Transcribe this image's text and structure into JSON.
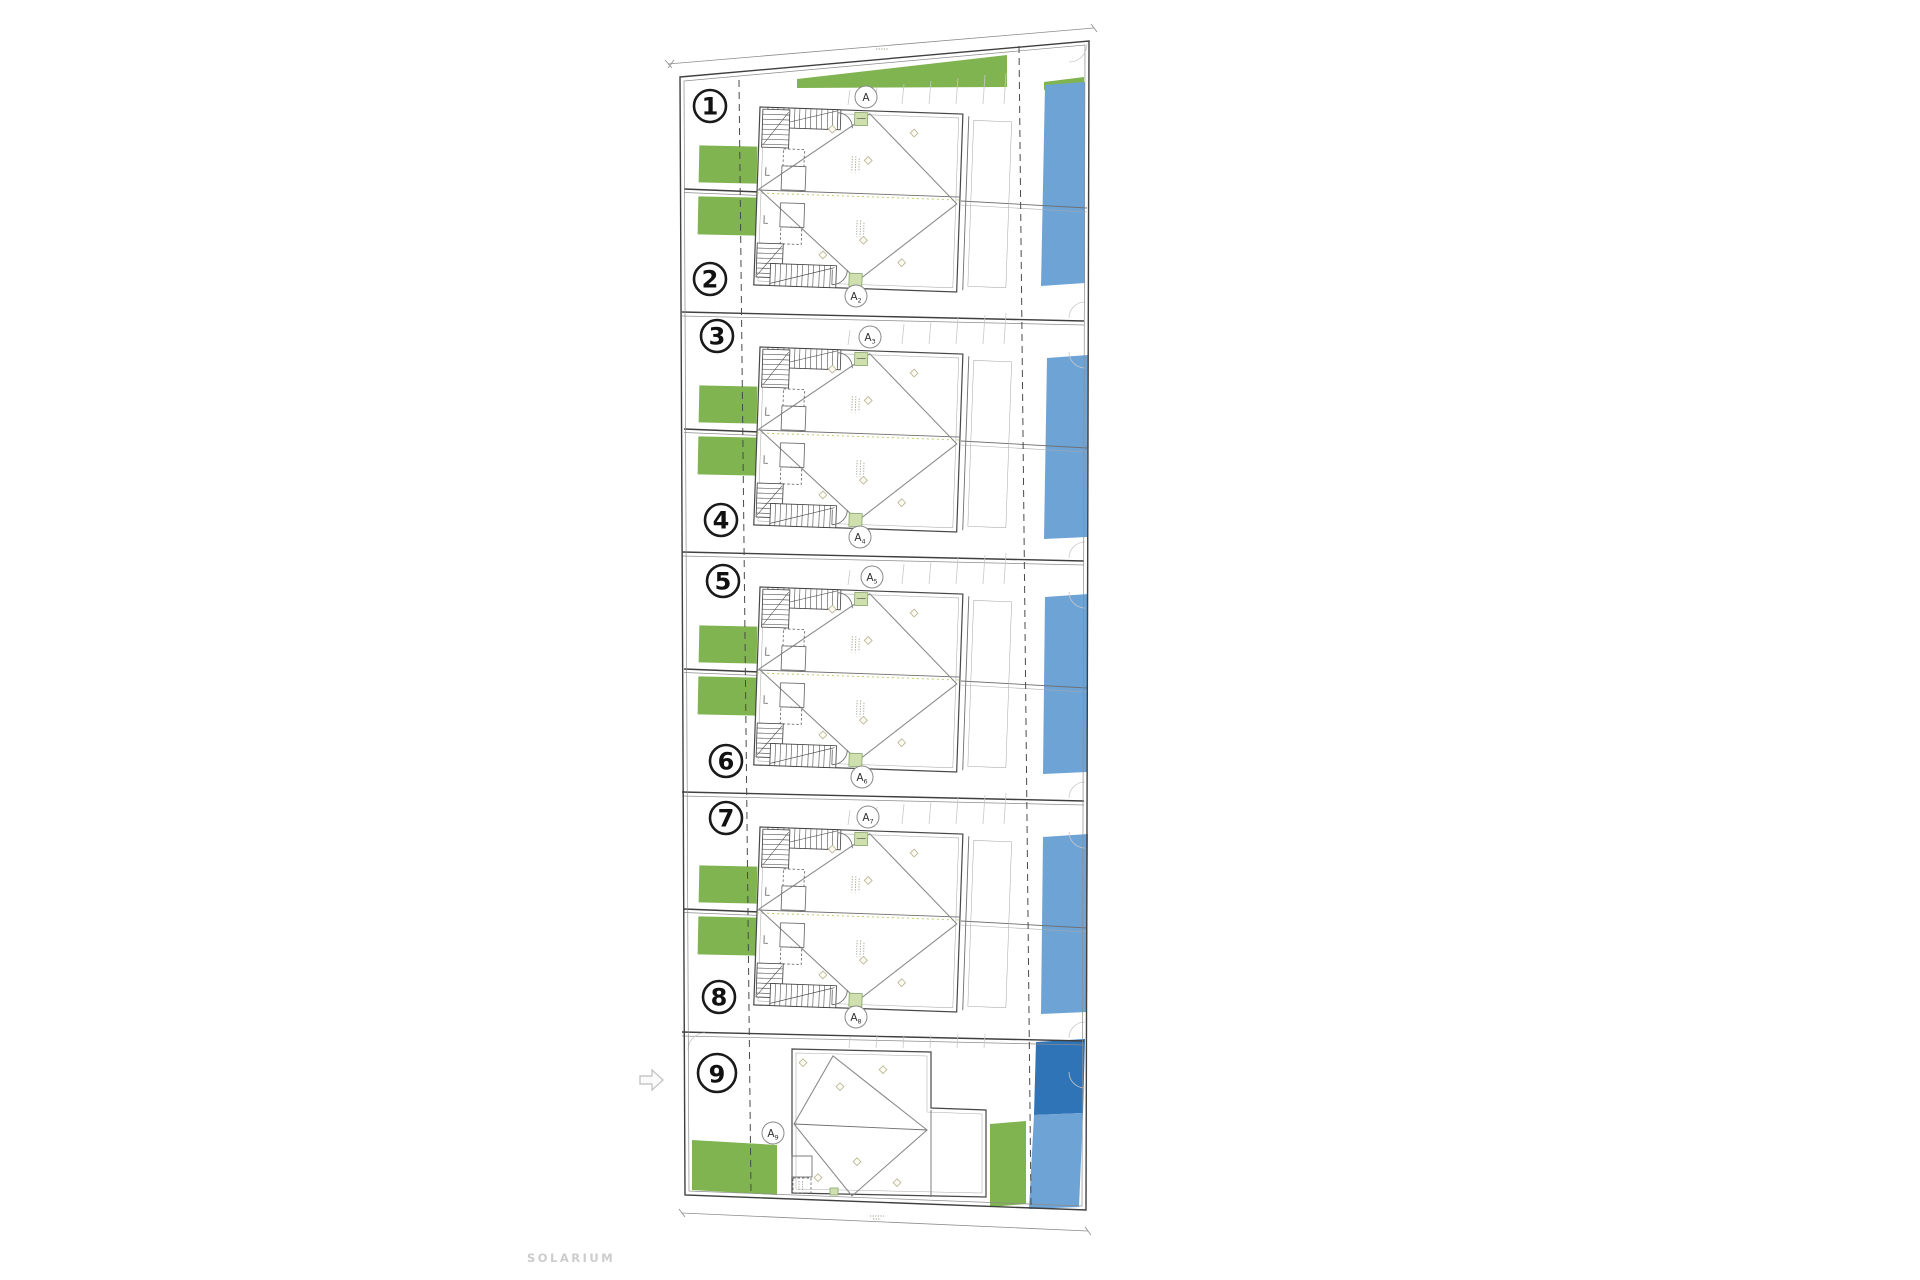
{
  "plan": {
    "type": "residential-site-plan",
    "units": [
      {
        "id": 1,
        "label": "1"
      },
      {
        "id": 2,
        "label": "2"
      },
      {
        "id": 3,
        "label": "3"
      },
      {
        "id": 4,
        "label": "4"
      },
      {
        "id": 5,
        "label": "5"
      },
      {
        "id": 6,
        "label": "6"
      },
      {
        "id": 7,
        "label": "7"
      },
      {
        "id": 8,
        "label": "8"
      },
      {
        "id": 9,
        "label": "9"
      }
    ],
    "section_markers": [
      {
        "label": "A",
        "sub": ""
      },
      {
        "label": "A",
        "sub": "2"
      },
      {
        "label": "A",
        "sub": "3"
      },
      {
        "label": "A",
        "sub": "4"
      },
      {
        "label": "A",
        "sub": "5"
      },
      {
        "label": "A",
        "sub": "6"
      },
      {
        "label": "A",
        "sub": "7"
      },
      {
        "label": "A",
        "sub": "8"
      },
      {
        "label": "A",
        "sub": "9"
      }
    ],
    "annotations": {
      "solarium": "SOLARIUM"
    },
    "colors": {
      "garden_green": "#80b450",
      "garden_light": "#cfe0ae",
      "pool_light": "#6ea3d6",
      "pool_dark": "#2e74b6",
      "boundary_line": "#3f3f3f",
      "label_gray": "#cccccc"
    }
  }
}
